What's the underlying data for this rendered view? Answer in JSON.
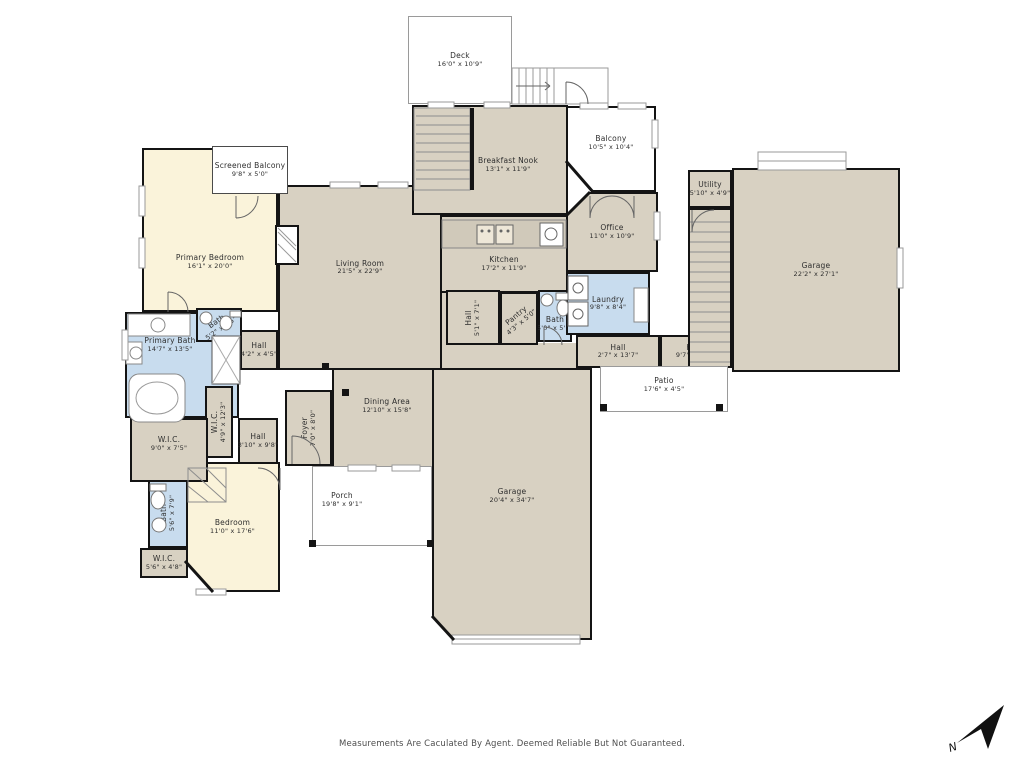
{
  "palette": {
    "page_bg": "#ffffff",
    "room_tan": "#d8d1c2",
    "room_cream": "#faf3da",
    "room_blue": "#c8dcee",
    "outdoor_white": "#ffffff",
    "wall": "#141414",
    "thin_line": "#9a9a9a",
    "label_text": "#2e2e2e"
  },
  "footer": {
    "disclaimer": "Measurements Are Caculated By Agent. Deemed Reliable But Not Guaranteed."
  },
  "compass": {
    "label": "N"
  },
  "rooms": [
    {
      "id": "filler-hall-gap",
      "x": 442,
      "y": 288,
      "w": 30,
      "h": 60,
      "fill": "room_tan",
      "wall": "none"
    },
    {
      "id": "filler-dining-gap",
      "x": 442,
      "y": 343,
      "w": 134,
      "h": 27,
      "fill": "room_tan",
      "wall": "none"
    },
    {
      "id": "living-room",
      "label": "Living Room",
      "dims": "21'5\" x 22'9\"",
      "x": 278,
      "y": 185,
      "w": 164,
      "h": 185,
      "fill": "room_tan",
      "wall": "wall",
      "dy": -10
    },
    {
      "id": "dining-area",
      "label": "Dining Area",
      "dims": "12'10\" x 15'8\"",
      "x": 332,
      "y": 368,
      "w": 110,
      "h": 100,
      "fill": "room_tan",
      "wall": "wall",
      "dy": -12
    },
    {
      "id": "foyer",
      "label": "Foyer",
      "dims": "7'0\" x 8'0\"",
      "x": 285,
      "y": 390,
      "w": 47,
      "h": 76,
      "fill": "room_tan",
      "wall": "wall",
      "rot": -90
    },
    {
      "id": "breakfast-nook",
      "label": "Breakfast Nook",
      "dims": "13'1\" x 11'9\"",
      "x": 412,
      "y": 105,
      "w": 156,
      "h": 110,
      "fill": "room_tan",
      "wall": "wall",
      "dx": 18,
      "dy": 5
    },
    {
      "id": "kitchen",
      "label": "Kitchen",
      "dims": "17'2\" x 11'9\"",
      "x": 440,
      "y": 215,
      "w": 128,
      "h": 78,
      "fill": "room_tan",
      "wall": "wall",
      "dy": 10
    },
    {
      "id": "office",
      "label": "Office",
      "dims": "11'0\" x 10'9\"",
      "x": 566,
      "y": 192,
      "w": 92,
      "h": 80,
      "fill": "room_tan",
      "wall": "wall",
      "clip": "polygon(26% 0,100% 0,100% 100%,0 100%,0 30%)"
    },
    {
      "id": "primary-bedroom",
      "label": "Primary Bedroom",
      "dims": "16'1\" x 20'0\"",
      "x": 142,
      "y": 148,
      "w": 136,
      "h": 164,
      "fill": "room_cream",
      "wall": "wall",
      "dy": 32
    },
    {
      "id": "bedroom",
      "label": "Bedroom",
      "dims": "11'0\" x 17'6\"",
      "x": 185,
      "y": 462,
      "w": 95,
      "h": 130,
      "fill": "room_cream",
      "wall": "wall",
      "clip": "polygon(0 0,100% 0,100% 100%,30% 100%,0 76%)"
    },
    {
      "id": "screened-balcony",
      "label": "Screened Balcony",
      "dims": "9'8\" x 5'0\"",
      "x": 212,
      "y": 146,
      "w": 76,
      "h": 48,
      "fill": "outdoor_white",
      "wall": "screen"
    },
    {
      "id": "primary-bath",
      "label": "Primary Bath",
      "dims": "14'7\" x 13'5\"",
      "x": 125,
      "y": 312,
      "w": 114,
      "h": 106,
      "fill": "room_blue",
      "wall": "wall",
      "dx": -12,
      "dy": -20
    },
    {
      "id": "bath-primary-wc",
      "label": "Bath",
      "dims": "5'2\" x 7'5\"",
      "x": 196,
      "y": 308,
      "w": 46,
      "h": 34,
      "fill": "room_blue",
      "wall": "wall",
      "rot": -35
    },
    {
      "id": "bath-middle",
      "label": "Bath",
      "dims": "5'0\" x 5'0\"",
      "x": 538,
      "y": 290,
      "w": 34,
      "h": 52,
      "fill": "room_blue",
      "wall": "wall",
      "dy": 8
    },
    {
      "id": "laundry",
      "label": "Laundry",
      "dims": "9'8\" x 8'4\"",
      "x": 566,
      "y": 272,
      "w": 84,
      "h": 63,
      "fill": "room_blue",
      "wall": "wall"
    },
    {
      "id": "bath-bedroom",
      "label": "Bath",
      "dims": "5'6\" x 7'9\"",
      "x": 148,
      "y": 478,
      "w": 40,
      "h": 70,
      "fill": "room_blue",
      "wall": "wall",
      "rot": -90
    },
    {
      "id": "hall-kitchen",
      "label": "Hall",
      "dims": "5'1\" x 7'1\"",
      "x": 446,
      "y": 290,
      "w": 54,
      "h": 55,
      "fill": "room_tan",
      "wall": "wall",
      "rot": -90
    },
    {
      "id": "pantry",
      "label": "Pantry",
      "dims": "4'3\" x 5'0\"",
      "x": 500,
      "y": 292,
      "w": 38,
      "h": 53,
      "fill": "room_tan",
      "wall": "wall",
      "rot": -40
    },
    {
      "id": "hall-mid-left",
      "label": "Hall",
      "dims": "2'7\" x 13'7\"",
      "x": 576,
      "y": 335,
      "w": 84,
      "h": 33,
      "fill": "room_tan",
      "wall": "wall"
    },
    {
      "id": "hall-mid-right",
      "label": "Hall",
      "dims": "9'7\" x 9'0\"",
      "x": 660,
      "y": 335,
      "w": 68,
      "h": 33,
      "fill": "room_tan",
      "wall": "wall"
    },
    {
      "id": "hall-bath",
      "label": "Hall",
      "dims": "4'2\" x 4'5\"",
      "x": 240,
      "y": 330,
      "w": 38,
      "h": 40,
      "fill": "room_tan",
      "wall": "wall"
    },
    {
      "id": "wic-vertical",
      "label": "W.I.C.",
      "dims": "4'9\" x 12'3\"",
      "x": 205,
      "y": 386,
      "w": 28,
      "h": 72,
      "fill": "room_tan",
      "wall": "wall",
      "rot": -90
    },
    {
      "id": "wic-left",
      "label": "W.I.C.",
      "dims": "9'0\" x 7'5\"",
      "x": 130,
      "y": 418,
      "w": 78,
      "h": 64,
      "fill": "room_tan",
      "wall": "wall",
      "dy": -6
    },
    {
      "id": "hall-bedroom",
      "label": "Hall",
      "dims": "3'10\" x 9'8\"",
      "x": 238,
      "y": 418,
      "w": 40,
      "h": 46,
      "fill": "room_tan",
      "wall": "wall"
    },
    {
      "id": "wic-bottom",
      "label": "W.I.C.",
      "dims": "5'6\" x 4'8\"",
      "x": 140,
      "y": 548,
      "w": 48,
      "h": 30,
      "fill": "room_tan",
      "wall": "wall"
    },
    {
      "id": "utility",
      "label": "Utility",
      "dims": "5'10\" x 4'9\"",
      "x": 688,
      "y": 170,
      "w": 44,
      "h": 38,
      "fill": "room_tan",
      "wall": "wall"
    },
    {
      "id": "stairwell-right",
      "x": 688,
      "y": 208,
      "w": 44,
      "h": 160,
      "fill": "room_tan",
      "wall": "wall"
    },
    {
      "id": "garage-right",
      "label": "Garage",
      "dims": "22'2\" x 27'1\"",
      "x": 732,
      "y": 168,
      "w": 168,
      "h": 204,
      "fill": "room_tan",
      "wall": "wall"
    },
    {
      "id": "garage-bottom",
      "label": "Garage",
      "dims": "20'4\" x 34'7\"",
      "x": 432,
      "y": 368,
      "w": 160,
      "h": 272,
      "fill": "room_tan",
      "wall": "wall",
      "dy": -8,
      "clip": "polygon(0 0,100% 0,100% 100%,14% 100%,0 91%)"
    },
    {
      "id": "deck",
      "label": "Deck",
      "dims": "16'0\" x 10'9\"",
      "x": 408,
      "y": 16,
      "w": 104,
      "h": 88,
      "fill": "outdoor_white",
      "wall": "thin"
    },
    {
      "id": "balcony",
      "label": "Balcony",
      "dims": "10'5\" x 10'4\"",
      "x": 566,
      "y": 106,
      "w": 90,
      "h": 86,
      "fill": "outdoor_white",
      "wall": "wall",
      "dy": -6,
      "clip": "polygon(0 0,100% 0,100% 100%,30% 100%,0 64%)"
    },
    {
      "id": "porch",
      "label": "Porch",
      "dims": "19'8\" x 9'1\"",
      "x": 312,
      "y": 466,
      "w": 120,
      "h": 80,
      "fill": "outdoor_white",
      "wall": "thin",
      "dx": -30,
      "dy": -6
    },
    {
      "id": "patio",
      "label": "Patio",
      "dims": "17'6\" x 4'5\"",
      "x": 600,
      "y": 366,
      "w": 128,
      "h": 46,
      "fill": "outdoor_white",
      "wall": "thin",
      "dy": -4
    }
  ]
}
